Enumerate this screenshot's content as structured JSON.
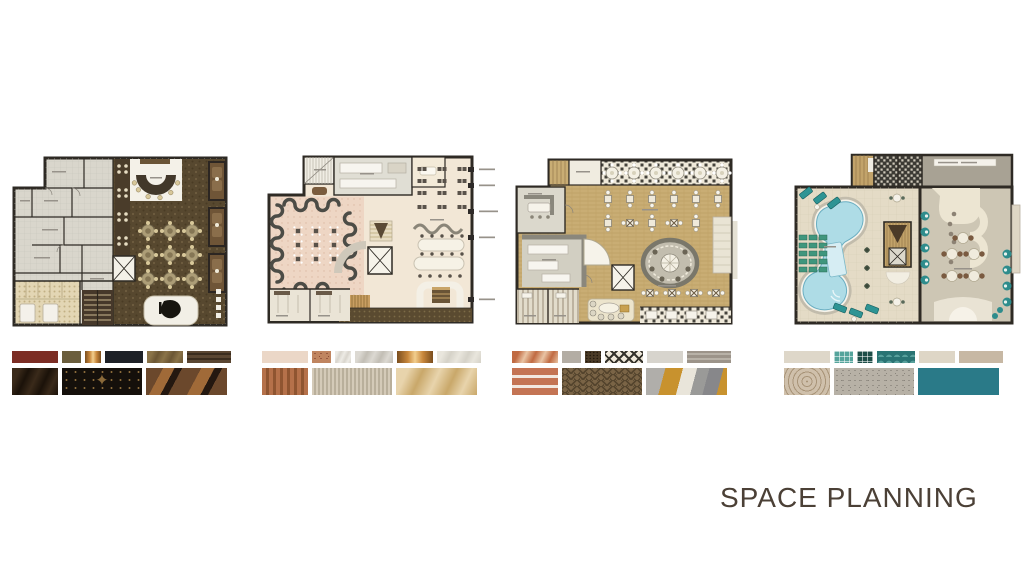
{
  "title": {
    "text": "SPACE PLANNING",
    "color": "#4b4036"
  },
  "boards": [
    {
      "name": "lounge-bar-floor-plan",
      "plan_colors": {
        "wall": "#2e2a24",
        "floor": "#57482f",
        "back": "#d9d6cc",
        "accent": "#f4f1e8",
        "tile": "#e3d6b4"
      },
      "palette": [
        [
          {
            "name": "maroon-leather",
            "style": "solid",
            "colors": [
              "#7c2d24"
            ],
            "w": 46
          },
          {
            "name": "olive-wood",
            "style": "solid",
            "colors": [
              "#6b5e3d"
            ],
            "w": 19
          },
          {
            "name": "copper-metal",
            "style": "copper",
            "colors": [
              "#c8873c",
              "#f2ce8e"
            ],
            "w": 16
          },
          {
            "name": "charcoal-navy",
            "style": "solid",
            "colors": [
              "#1e2127"
            ],
            "w": 38
          },
          {
            "name": "walnut-veneer",
            "style": "marble",
            "colors": [
              "#8a7348",
              "#6b5634"
            ],
            "w": 36
          },
          {
            "name": "dark-wood-stripe",
            "style": "hstripes",
            "colors": [
              "#5a4632",
              "#3a2c1e"
            ],
            "w": 44
          }
        ],
        [
          {
            "name": "dark-emperador-marble",
            "style": "marble",
            "colors": [
              "#3a2a1a",
              "#1b1209"
            ],
            "w": 46
          },
          {
            "name": "black-gold-fabric",
            "style": "ornament",
            "colors": [
              "#15100b",
              "#8a6a3a"
            ],
            "w": 80
          },
          {
            "name": "art-deco-marquetry",
            "style": "artdeco",
            "colors": [
              "#6b482c",
              "#a06a38"
            ],
            "w": 81
          }
        ]
      ]
    },
    {
      "name": "blush-restaurant-floor-plan",
      "plan_colors": {
        "wall": "#2e2a24",
        "floor": "#f2e7d6",
        "blush": "#eed6c4",
        "wavy": "#4c4c46",
        "grey": "#e0ded4",
        "band": "#5a4a30",
        "gold": "#c89e62"
      },
      "palette": [
        [
          {
            "name": "blush-plaster",
            "style": "solid",
            "colors": [
              "#ebd7c7"
            ],
            "w": 46
          },
          {
            "name": "terracotta-stone",
            "style": "speckle",
            "colors": [
              "#c08560",
              "#8a4a35"
            ],
            "w": 19
          },
          {
            "name": "white-marble",
            "style": "marble",
            "colors": [
              "#edebe5",
              "#d9d5cd"
            ],
            "w": 16
          },
          {
            "name": "grey-marble",
            "style": "marble",
            "colors": [
              "#dcd9d2",
              "#c2beb5"
            ],
            "w": 38
          },
          {
            "name": "copper-metal",
            "style": "copper",
            "colors": [
              "#c8873c",
              "#f2ce8e"
            ],
            "w": 36
          },
          {
            "name": "ivory-texture",
            "style": "marble",
            "colors": [
              "#e9e6dd",
              "#d5d2c8"
            ],
            "w": 44
          }
        ],
        [
          {
            "name": "terracotta-slats",
            "style": "vstripes",
            "colors": [
              "#b5714a",
              "#8f5531"
            ],
            "w": 46
          },
          {
            "name": "beige-fluted-panel",
            "style": "vstripes-fine",
            "colors": [
              "#d4cab8",
              "#b9af9b"
            ],
            "w": 80
          },
          {
            "name": "honey-onyx-marble",
            "style": "marble",
            "colors": [
              "#e8d4ac",
              "#c9a86a"
            ],
            "w": 81
          }
        ]
      ]
    },
    {
      "name": "wood-restaurant-floor-plan",
      "plan_colors": {
        "wall": "#2e2a24",
        "floor": "#c9ad74",
        "grey": "#d2cfc2",
        "greywall": "#8a877c",
        "checkbg": "#efe9da",
        "checkfg": "#45433c"
      },
      "palette": [
        [
          {
            "name": "rust-marble",
            "style": "marble",
            "colors": [
              "#c06a42",
              "#e9c4a4"
            ],
            "w": 46
          },
          {
            "name": "grey-stone",
            "style": "solid",
            "colors": [
              "#b3ada4"
            ],
            "w": 19
          },
          {
            "name": "dark-rattan-weave",
            "style": "woven",
            "colors": [
              "#4a3a26",
              "#241a0e"
            ],
            "w": 16
          },
          {
            "name": "harlequin-tile",
            "style": "diamond",
            "colors": [
              "#efe8da",
              "#35332c"
            ],
            "w": 38
          },
          {
            "name": "light-grey-stone",
            "style": "solid",
            "colors": [
              "#d7d4cd"
            ],
            "w": 36
          },
          {
            "name": "grey-wood-plank",
            "style": "hstripes",
            "colors": [
              "#9c948a",
              "#b8b2a8"
            ],
            "w": 44
          }
        ],
        [
          {
            "name": "terracotta-frieze-tile",
            "style": "tilerows",
            "colors": [
              "#c47454",
              "#f2e8e0"
            ],
            "w": 46
          },
          {
            "name": "herringbone-wood",
            "style": "herringbone",
            "colors": [
              "#7a6446",
              "#55452e"
            ],
            "w": 80
          },
          {
            "name": "gilded-abstract-art",
            "style": "abstract",
            "colors": [
              "#c8922e",
              "#9a9a98"
            ],
            "w": 81
          }
        ]
      ]
    },
    {
      "name": "pool-deck-floor-plan",
      "plan_colors": {
        "wall": "#2e2a24",
        "deck": "#e4dbc6",
        "right": "#cdc6b4",
        "pool": "#aedce6",
        "teal": "#2e8c8c",
        "green": "#3f967d",
        "wood": "#c2a36a",
        "cream": "#ece5d2",
        "greyroom": "#a8a294",
        "dark": "#3c3a34"
      },
      "palette": [
        [
          {
            "name": "bone-tile",
            "style": "solid",
            "colors": [
              "#ded7c9"
            ],
            "w": 46
          },
          {
            "name": "teal-mosaic",
            "style": "mosaic",
            "colors": [
              "#55a49c",
              "#ffffff"
            ],
            "w": 19
          },
          {
            "name": "deep-teal-mosaic",
            "style": "mosaic",
            "colors": [
              "#1e4e48",
              "#ffffff"
            ],
            "w": 16
          },
          {
            "name": "teal-fishscale-tile",
            "style": "scale",
            "colors": [
              "#2a7474",
              "#58a09c"
            ],
            "w": 38
          },
          {
            "name": "ivory-plaster",
            "style": "solid",
            "colors": [
              "#ded6c6"
            ],
            "w": 36
          },
          {
            "name": "taupe-stone",
            "style": "solid",
            "colors": [
              "#c7b8a4"
            ],
            "w": 44
          }
        ],
        [
          {
            "name": "beige-medallion-carpet",
            "style": "medallion",
            "colors": [
              "#cfc0ab",
              "#a89478"
            ],
            "w": 46
          },
          {
            "name": "terrazzo-stone",
            "style": "speckle",
            "colors": [
              "#b7b1a6",
              "#8a857c"
            ],
            "w": 80
          },
          {
            "name": "teal-lacquer",
            "style": "solid",
            "colors": [
              "#2a7a88"
            ],
            "w": 81
          }
        ]
      ]
    }
  ]
}
